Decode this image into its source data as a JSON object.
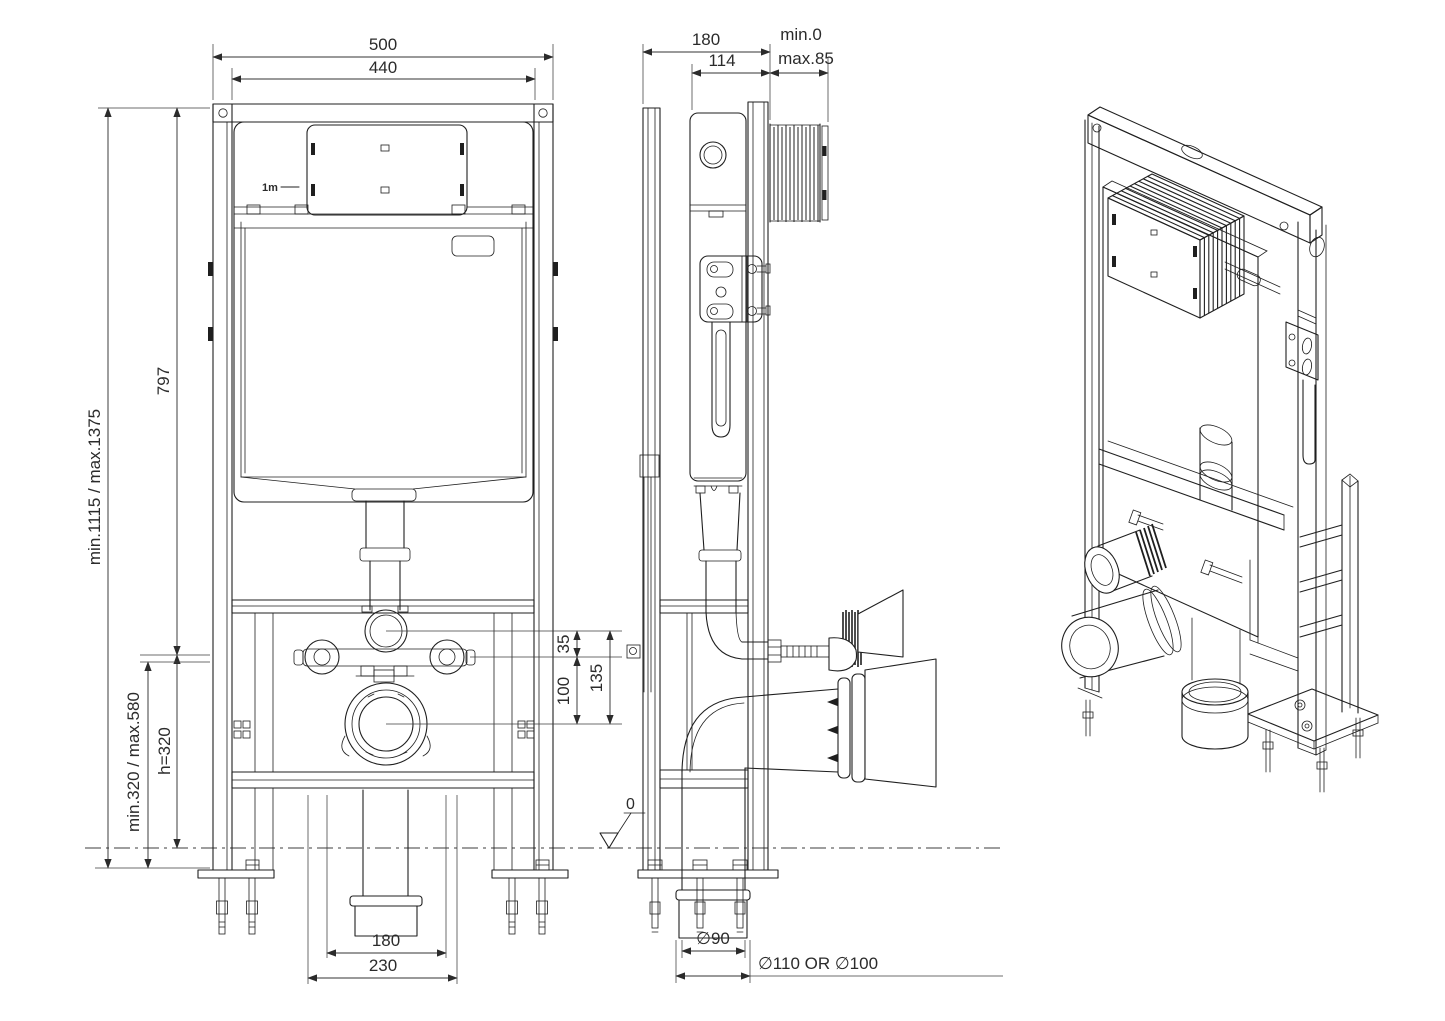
{
  "meta": {
    "type": "technical installation drawing",
    "subject": "concealed cistern wall-mounting frame",
    "background": "#ffffff",
    "line_color": "#1f1f1f",
    "dimension_color": "#333333"
  },
  "front": {
    "name": "front view",
    "dim_overall_width": "500",
    "dim_inner_width": "440",
    "dim_height_range": "min.1115 / max.1375",
    "dim_frame_height": "797",
    "dim_floor_range": "min.320 / max.580",
    "dim_bar_height": "h=320",
    "dim_flush_offset": "35",
    "dim_bar_to_outlet": "100",
    "dim_flush_to_outlet": "135",
    "dim_outlet_width": "180",
    "dim_bracket_spacing": "230",
    "scale_marker": "1m"
  },
  "side": {
    "name": "side view",
    "dim_depth": "180",
    "dim_rail_depth": "114",
    "dim_wall_min": "min.0",
    "dim_wall_max": "max.85",
    "datum_level": "0",
    "dim_outlet_diameter": "∅90",
    "dim_connection_diameter": "∅110 OR ∅100"
  },
  "iso": {
    "name": "isometric view"
  }
}
